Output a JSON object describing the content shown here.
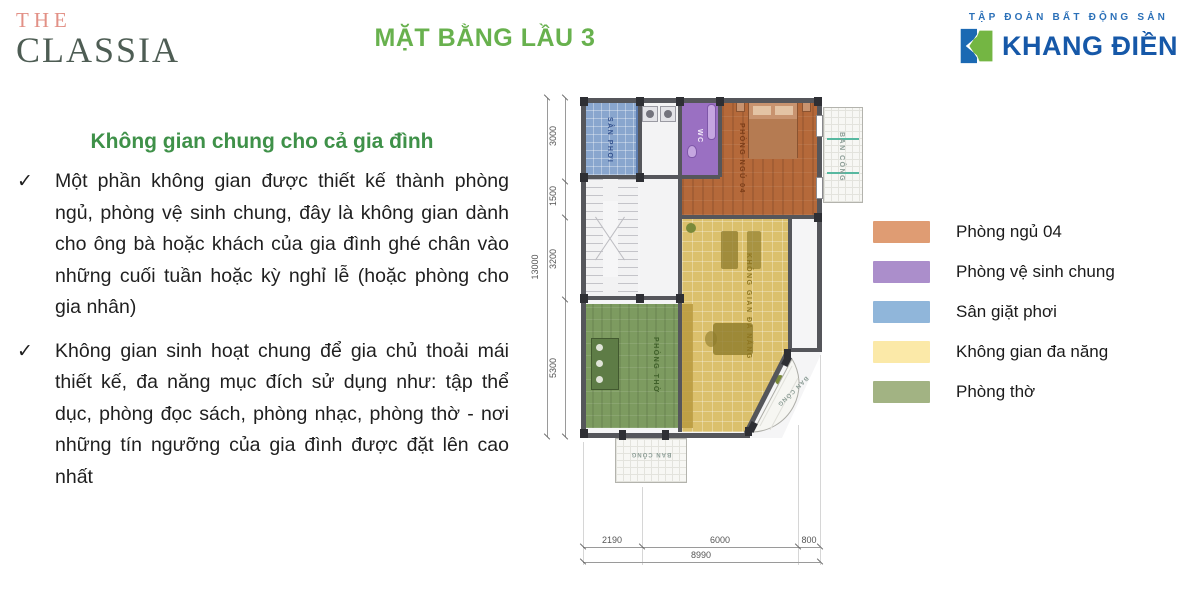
{
  "header": {
    "logo": {
      "the": "THE",
      "classia": "CLASSIA"
    },
    "title": "MẶT BẰNG LẦU 3",
    "brand": {
      "tagline": "TẬP ĐOÀN BẤT ĐỘNG SẢN",
      "name": "KHANG ĐIỀN"
    }
  },
  "content": {
    "heading": "Không gian chung cho cả gia đình",
    "check": "✓",
    "bullets": [
      "Một phần không gian được thiết kế thành phòng ngủ, phòng vệ sinh chung, đây là không gian dành cho ông bà hoặc khách của gia đình ghé chân vào những cuối tuần hoặc kỳ nghỉ lễ (hoặc phòng cho gia nhân)",
      "Không gian sinh hoạt chung để gia chủ thoải mái thiết kế, đa năng mục đích sử dụng như: tập thể dục, phòng đọc sách, phòng nhạc, phòng thờ - nơi những tín ngưỡng của gia đình được đặt lên cao nhất"
    ]
  },
  "floorplan": {
    "rooms": {
      "san_phoi": "SÂN PHƠI",
      "wc": "WC",
      "phong_ngu": "PHÒNG NGỦ 04",
      "da_nang": "KHÔNG GIAN ĐA NĂNG",
      "phong_tho": "PHÒNG THỜ",
      "ban_cong": "BAN CÔNG"
    },
    "dims": {
      "left": [
        "3000",
        "1500",
        "3200",
        "5300"
      ],
      "left_total": "13000",
      "bottom": [
        "2190",
        "6000",
        "800"
      ],
      "bottom_total": "8990"
    }
  },
  "legend": {
    "items": [
      {
        "label": "Phòng ngủ 04",
        "color": "#df9c73"
      },
      {
        "label": "Phòng vệ sinh chung",
        "color": "#ab8ecb"
      },
      {
        "label": "Sân giặt phơi",
        "color": "#90b6da"
      },
      {
        "label": "Không gian đa năng",
        "color": "#fbe9a8"
      },
      {
        "label": "Phòng thờ",
        "color": "#a2b383"
      }
    ]
  },
  "theme": {
    "title_green": "#68b14e",
    "heading_green": "#3f9149",
    "brand_blue": "#1658a8",
    "logo_pink": "#e29086",
    "logo_green": "#4e5d54"
  }
}
